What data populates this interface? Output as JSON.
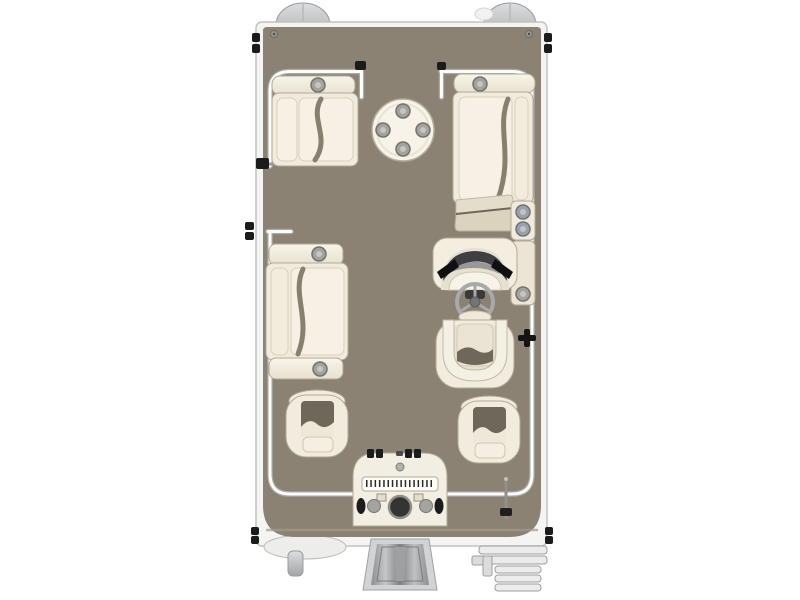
{
  "scene": {
    "description": "Top-down pontoon boat floor plan illustration",
    "background": "#ffffff"
  },
  "palette": {
    "background": "#ffffff",
    "deck": "#8b8274",
    "hull": "#f4f4f2",
    "hull_line": "#c2c2c0",
    "rail": "#fcfcfa",
    "rail_line": "#a8a8a4",
    "upholstery": "#f2ecdf",
    "upholstery_line": "#b2a996",
    "cushion": "#f6f1e4",
    "cushion_line": "#d8d0bd",
    "cushion_gap": "#87806f",
    "cupholder": "#a3a29e",
    "cupholder_blue": "#9aa1a8",
    "windshield": "#3f3f42",
    "hardware_black": "#1b1b1b",
    "metal_light": "#d9dadb",
    "metal_dark": "#8e8f92"
  },
  "components": {
    "hull": "Pontoon hull",
    "deck": "Deck floor",
    "rail": "Perimeter fence rail",
    "bow_gate": "Bow boarding gate",
    "port_gate": "Port side gate",
    "pontoon_left_nose": "Port pontoon nose cone",
    "pontoon_right_nose": "Starboard pontoon nose cone",
    "stern_light": "Bow navigation light",
    "pontoon_stern_tip": "Port pontoon stern tip with transducer",
    "bow_port_lounge": "Bow port lounge seat with cup holder",
    "bow_starboard_lounge": "Starboard chaise lounge with cup holder",
    "bow_table": "Round bow table with four cup holders",
    "port_mid_lounge": "Port midship double lounge seat",
    "helm_console": "Helm console with windshield",
    "steering_wheel": "Steering wheel",
    "captain_chair": "Captain's chair",
    "side_cupholder_panel": "Starboard cup holder panel",
    "helm_side_panel": "Helm side panel with cup holder",
    "port_fishing_chair": "Port stern fishing chair",
    "starboard_fishing_chair": "Starboard stern fishing chair",
    "stern_station": "Stern fishing station",
    "fish_ruler": "Fish measuring ruler",
    "livewell_knob": "Livewell control knob",
    "rod_holders": "Rod holders",
    "outboard_motor": "Outboard motor",
    "boarding_ladder": "Stern boarding ladder",
    "stern_latch": "Stern gate latch",
    "cleat": "Starboard mooring cleat",
    "hinges": "Gate hinge hardware",
    "deck_screws": "Deck corner screws"
  }
}
